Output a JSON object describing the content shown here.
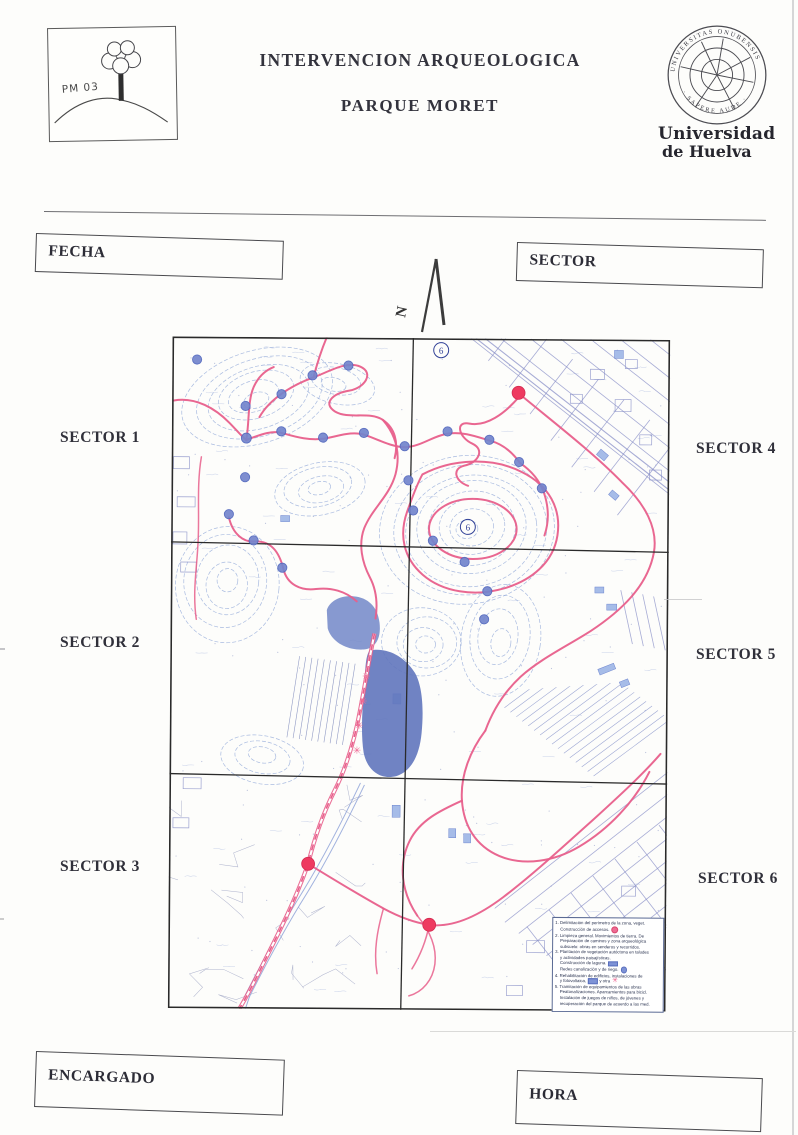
{
  "page": {
    "logo_code": "PM 03",
    "title1": "INTERVENCION ARQUEOLOGICA",
    "title2": "PARQUE MORET",
    "seal_top": "UNIVERSITAS ONUBENSIS",
    "seal_bottom": "· SAPERE AUDE ·",
    "univ1": "Universidad",
    "univ2": "de Huelva"
  },
  "form": {
    "fecha": "FECHA",
    "sector": "SECTOR",
    "encargado": "ENCARGADO",
    "hora": "HORA"
  },
  "compass": {
    "n": "N"
  },
  "map": {
    "sectors": {
      "s1": "SECTOR 1",
      "s2": "SECTOR 2",
      "s3": "SECTOR 3",
      "s4": "SECTOR 4",
      "s5": "SECTOR 5",
      "s6": "SECTOR 6"
    },
    "note6a": "6",
    "note6b": "6",
    "legend": {
      "items": [
        {
          "lines": [
            "1. Delimitación del perímetro de la zona, veget.",
            "Construcción de accesos."
          ]
        },
        {
          "lines": [
            "2. Limpieza general. Movimientos de tierra. De",
            "Preparación de caminos y zona arqueológica",
            "subsuelo: obras en senderos y recorridos."
          ]
        },
        {
          "lines": [
            "3. Plantación de vegetación autóctona en taludes",
            "y actividades paisajísticas.",
            "Construcción de laguna.",
            "Redes canalización y de riego."
          ]
        },
        {
          "lines": [
            "4. Rehabilitación de edificios, instalaciones de",
            "y fotovoltaica,"
          ],
          "extra": "y otra"
        },
        {
          "lines": [
            "5. Tramitación de equipamientos de las obras",
            "Peatonalizaciones. Aparcamientos para bicicl.",
            "Instalación de juegos de niños, de jóvenes y",
            "recuperación del parque de acuerdo a las med."
          ]
        }
      ]
    },
    "colors": {
      "path_pink": "#e85f8b",
      "marker_red": "#ee3a60",
      "water_blue": "#6075bd",
      "contour_blue": "#94aad9",
      "tree_marker_blue": "#7385cd"
    }
  }
}
